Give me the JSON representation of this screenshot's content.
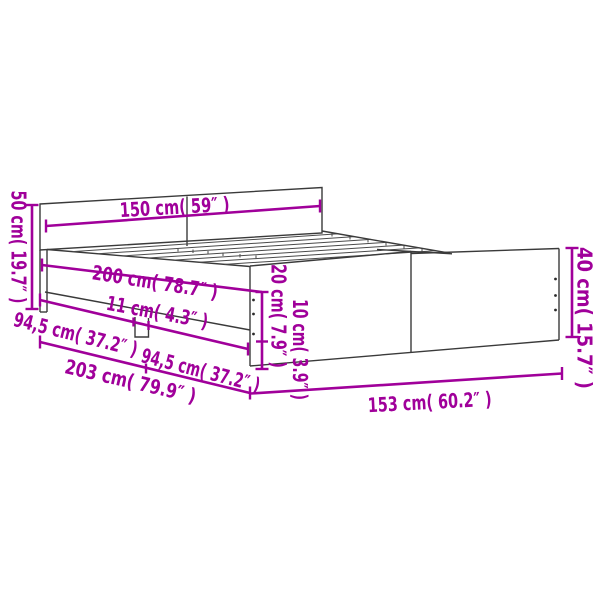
{
  "diagram": {
    "type": "product-dimension-diagram",
    "product": "bed-frame-with-headboard-and-footboard",
    "background_color": "#ffffff",
    "accent_color": "#A0009A",
    "line_art_color": "#3A3A3A",
    "dimensions": [
      {
        "id": "headboard-width",
        "label": "150 cm( 59″ )",
        "value_cm": "150",
        "value_inch": "59"
      },
      {
        "id": "bed-length",
        "label": "200 cm( 78.7″ )",
        "value_cm": "200",
        "value_inch": "78.7"
      },
      {
        "id": "center-leg-width",
        "label": "11 cm( 4.3″ )",
        "value_cm": "11",
        "value_inch": "4.3"
      },
      {
        "id": "side-rail-left-section",
        "label": "94,5 cm( 37.2″ )",
        "value_cm": "94,5",
        "value_inch": "37.2"
      },
      {
        "id": "side-rail-right-section",
        "label": "94,5 cm( 37.2″ )",
        "value_cm": "94,5",
        "value_inch": "37.2"
      },
      {
        "id": "total-length",
        "label": "203 cm( 79.9″ )",
        "value_cm": "203",
        "value_inch": "79.9"
      },
      {
        "id": "footboard-width",
        "label": "153 cm( 60.2″ )",
        "value_cm": "153",
        "value_inch": "60.2"
      },
      {
        "id": "headboard-height",
        "label": "50 cm( 19.7″ )",
        "value_cm": "50",
        "value_inch": "19.7"
      },
      {
        "id": "footboard-height",
        "label": "40 cm( 15.7″ )",
        "value_cm": "40",
        "value_inch": "15.7"
      },
      {
        "id": "rail-upper-height",
        "label": "20 cm( 7.9″ )",
        "value_cm": "20",
        "value_inch": "7.9"
      },
      {
        "id": "rail-lower-height",
        "label": "10 cm( 3.9″ )",
        "value_cm": "10",
        "value_inch": "3.9"
      }
    ]
  }
}
